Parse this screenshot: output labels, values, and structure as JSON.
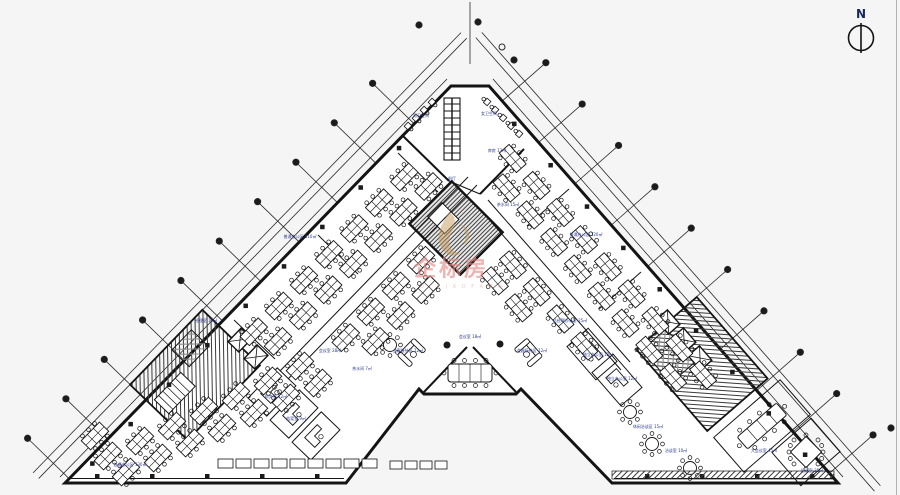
{
  "compass": {
    "label": "N"
  },
  "watermark": {
    "text": "企标房",
    "subtext": "Q I B I A O F A N G",
    "text_color": "#e58784",
    "logo_color": "#c49a5f"
  },
  "colors": {
    "background": "#f5f5f5",
    "line": "#141414",
    "room_label": "#2b3990",
    "border": "#b0b0b0"
  },
  "plan": {
    "labels": [
      {
        "text": "男卫生间",
        "x": 421,
        "y": 117
      },
      {
        "text": "女卫生间",
        "x": 489,
        "y": 115
      },
      {
        "text": "库房 13㎡",
        "x": 497,
        "y": 152
      },
      {
        "text": "茶水间 15㎡",
        "x": 508,
        "y": 206
      },
      {
        "text": "前厅",
        "x": 452,
        "y": 180
      },
      {
        "text": "普通办公区 110㎡",
        "x": 300,
        "y": 238
      },
      {
        "text": "普通办公区 120㎡",
        "x": 586,
        "y": 236
      },
      {
        "text": "经理室 15㎡",
        "x": 206,
        "y": 322
      },
      {
        "text": "会议室 28㎡",
        "x": 330,
        "y": 352
      },
      {
        "text": "茶水间 7㎡",
        "x": 362,
        "y": 370
      },
      {
        "text": "财务室 12㎡",
        "x": 276,
        "y": 398
      },
      {
        "text": "档案室 9㎡",
        "x": 296,
        "y": 420
      },
      {
        "text": "普通办公区 130㎡",
        "x": 130,
        "y": 466
      },
      {
        "text": "会客接待区 12㎡",
        "x": 408,
        "y": 352
      },
      {
        "text": "会议室 18㎡",
        "x": 470,
        "y": 338
      },
      {
        "text": "会客接待区 12㎡",
        "x": 532,
        "y": 352
      },
      {
        "text": "总经理办公室 25㎡",
        "x": 570,
        "y": 322
      },
      {
        "text": "独立办公室 12㎡",
        "x": 598,
        "y": 356
      },
      {
        "text": "独立办公室 12㎡",
        "x": 622,
        "y": 380
      },
      {
        "text": "休闲洽谈区 15㎡",
        "x": 648,
        "y": 428
      },
      {
        "text": "洽谈室 10㎡",
        "x": 676,
        "y": 452
      },
      {
        "text": "大会议室 45㎡",
        "x": 764,
        "y": 452
      },
      {
        "text": "培训室 35㎡",
        "x": 812,
        "y": 472
      }
    ]
  }
}
